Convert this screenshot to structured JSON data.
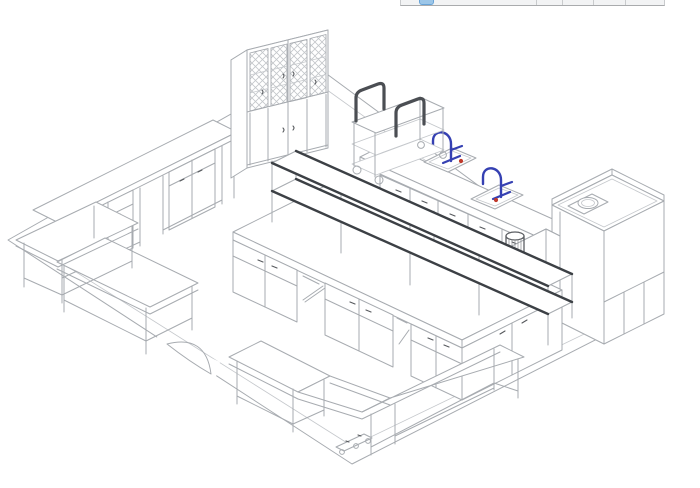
{
  "figure_colors": {
    "background": "#ffffff",
    "outline_gray": "#a7abb0",
    "outline_light": "#c5c8cc",
    "dark_detail": "#4b4e53",
    "faucet_blue": "#3540b2",
    "shelf_rail": "#3c4045",
    "marker_red": "#c0392b",
    "cylinder_gray": "#5c5f63"
  },
  "toolbar_fragment": {
    "background": "#f2f3f4",
    "border": "#a9abad",
    "divider": "#c9cbcd",
    "active_button_fill": "#9cc6e8",
    "active_button_border": "#68a4d8",
    "cell_count": 5,
    "divider_offsets_px": [
      135,
      161,
      192,
      224
    ]
  }
}
